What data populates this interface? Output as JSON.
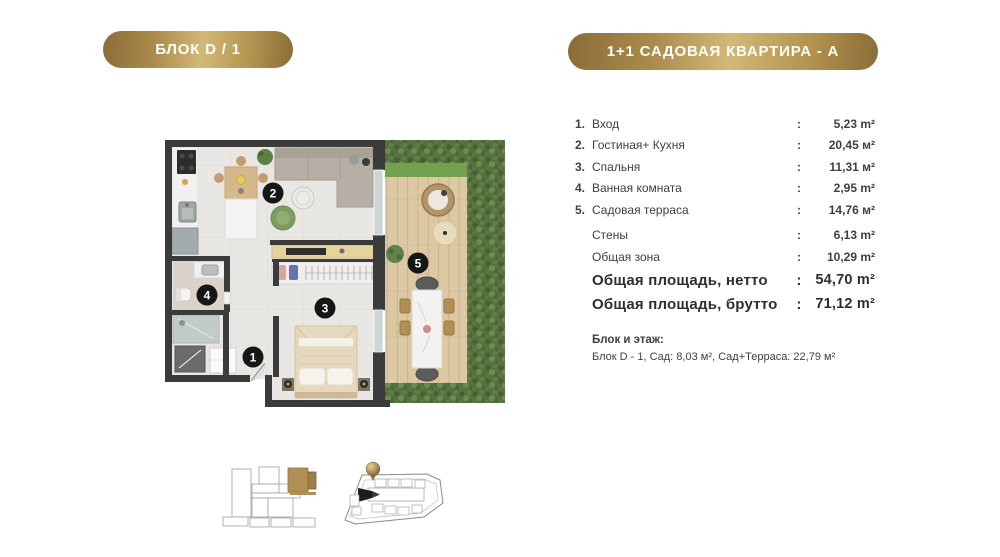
{
  "badges": {
    "block": "БЛОК D / 1",
    "apartment": "1+1 САДОВАЯ КВАРТИРА - А"
  },
  "separator": ":",
  "rooms": [
    {
      "num": "1.",
      "label": "Вход",
      "value": "5,23 m²"
    },
    {
      "num": "2.",
      "label": "Гостиная+ Кухня",
      "value": "20,45 м²"
    },
    {
      "num": "3.",
      "label": "Спальня",
      "value": "11,31 м²"
    },
    {
      "num": "4.",
      "label": "Ванная комната",
      "value": "2,95 m²"
    },
    {
      "num": "5.",
      "label": "Садовая терраса",
      "value": "14,76 м²"
    }
  ],
  "summary": [
    {
      "label": "Стены",
      "value": "6,13 m²"
    },
    {
      "label": "Общая зона",
      "value": "10,29 m²"
    },
    {
      "label": "Общая площадь, нетто",
      "value": "54,70 m²"
    },
    {
      "label": "Общая площадь, брутто",
      "value": "71,12 m²"
    }
  ],
  "block_info": {
    "title": "Блок и этаж:",
    "detail": "Блок D - 1, Сад: 8,03 м², Сад+Терраса: 22,79 м²"
  },
  "plan": {
    "unit_numbers": [
      "1",
      "2",
      "3",
      "4",
      "5"
    ]
  },
  "colors": {
    "gold_dark": "#8a6c38",
    "gold_light": "#d3b877",
    "wall": "#3b3b3b",
    "hedge_green": "#567040",
    "grass_green": "#74a150",
    "deck_wood": "#dcc9a4",
    "unit_badge": "#161616",
    "text": "#3f3f3f"
  }
}
